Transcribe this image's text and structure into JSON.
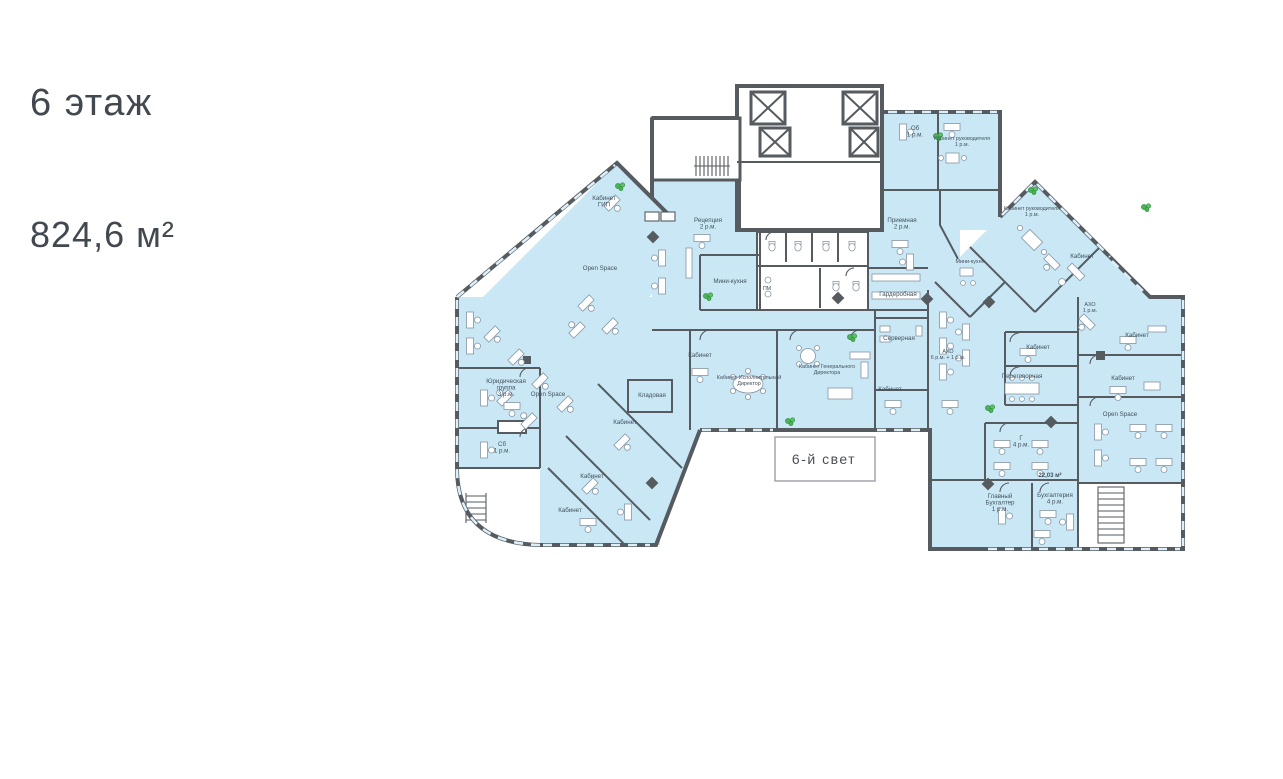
{
  "header": {
    "floor_title": "6 этаж",
    "area_label": "824,6 м²"
  },
  "colors": {
    "room_fill": "#c9e7f5",
    "wall": "#565b60",
    "label_text": "#44515c",
    "title_text": "#41484f",
    "plant_green": "#4cb257",
    "background": "#ffffff"
  },
  "plan": {
    "atrium": "6-й свет",
    "labels": {
      "gip": [
        "Кабинет",
        "ГИП"
      ],
      "open_space_1": [
        "Open Space"
      ],
      "open_space_2": [
        "Open Space"
      ],
      "open_space_3": [
        "Open Space"
      ],
      "legal": [
        "Юридическая",
        "группа",
        "3 р.м."
      ],
      "sb": [
        "Сб",
        "1 р.м."
      ],
      "storage": [
        "Кладовая"
      ],
      "cab_1": [
        "Кабинет"
      ],
      "cab_2": [
        "Кабинет"
      ],
      "cab_3": [
        "Кабинет"
      ],
      "cab_4": [
        "Кабинет"
      ],
      "cab_5": [
        "Кабинет"
      ],
      "cab_6": [
        "Кабинет"
      ],
      "cab_7": [
        "Кабинет"
      ],
      "cab_8": [
        "Кабинет"
      ],
      "cab_9": [
        "Кабинет"
      ],
      "reception": [
        "Рецепция",
        "2 р.м."
      ],
      "mini_kitchen_1": [
        "Мини-кухня"
      ],
      "pm": [
        "ПМ"
      ],
      "wardrobe": [
        "Гардеробная"
      ],
      "exec_dir": [
        "Кабинет Исполнительный",
        "Директор"
      ],
      "gen_dir": [
        "Кабинет Генерального",
        "Директора"
      ],
      "server": [
        "Серверная"
      ],
      "ob": [
        "Об",
        "1 р.м."
      ],
      "head_office_1": [
        "Кабинет руководителя",
        "1 р.м."
      ],
      "priem": [
        "Приемная",
        "2 р.м."
      ],
      "head_office_2": [
        "Кабинет руководителя",
        "1 р.м."
      ],
      "mini_kitchen_2": [
        "Мини-кухня"
      ],
      "aho_1": [
        "АХО",
        "1 р.м."
      ],
      "aho_2": [
        "АХО",
        "6 р.м. + 1 р.м."
      ],
      "meeting": [
        "Переговорная"
      ],
      "it_room": [
        "Г",
        "4 р.м."
      ],
      "area_22": [
        "22,03 м²"
      ],
      "chief_acct": [
        "Главный",
        "Бухгалтер",
        "1 р.м."
      ],
      "acct": [
        "Бухгалтерия",
        "4 р.м."
      ]
    }
  }
}
